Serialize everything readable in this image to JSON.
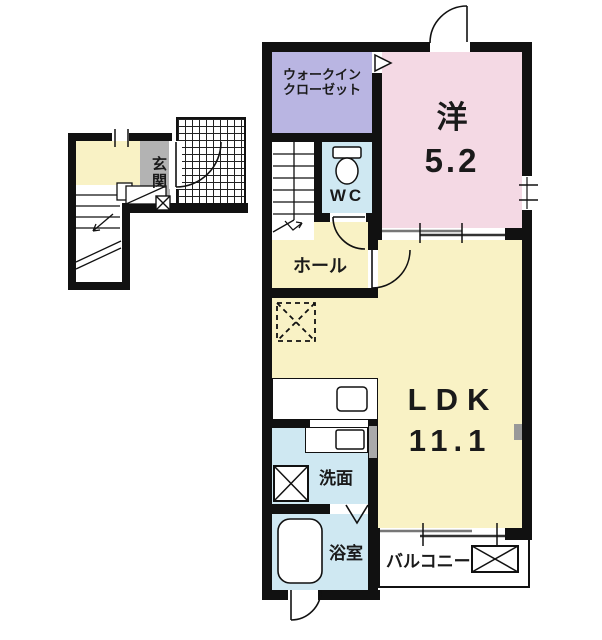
{
  "colors": {
    "wall": "#111111",
    "western_pink": "#f4d9e4",
    "closet_lavender": "#b9b5e2",
    "water_blue": "#cfe8f2",
    "floor_yellow": "#f9f2c5",
    "entrance_gray": "#b3b3b3",
    "balcony_white": "#ffffff",
    "line_gray": "#777777"
  },
  "rooms": {
    "walk_in_closet": {
      "label_line1": "ウォークイン",
      "label_line2": "クローゼット"
    },
    "western_room": {
      "label": "洋",
      "size": "5.2"
    },
    "wc": {
      "label": "WC"
    },
    "hall": {
      "label": "ホール"
    },
    "ldk": {
      "label": "LDK",
      "size": "11.1"
    },
    "washroom": {
      "label": "洗面"
    },
    "bathroom": {
      "label": "浴室"
    },
    "balcony": {
      "label": "バルコニー"
    },
    "entrance": {
      "label": "玄関"
    }
  },
  "icons": {
    "toilet": "toilet-icon",
    "bathtub": "bathtub-icon",
    "kitchen_sink": "sink-icon",
    "wash_basin": "basin-icon",
    "washing_machine_space": "cross-box-icon",
    "refrigerator_space": "dashed-cross-box-icon",
    "balcony_equipment": "cross-box-icon",
    "stairs": "stairs-icon",
    "swing_door": "door-arc-icon",
    "sliding_window": "sliding-window-icon",
    "folding_door": "folding-door-icon"
  }
}
